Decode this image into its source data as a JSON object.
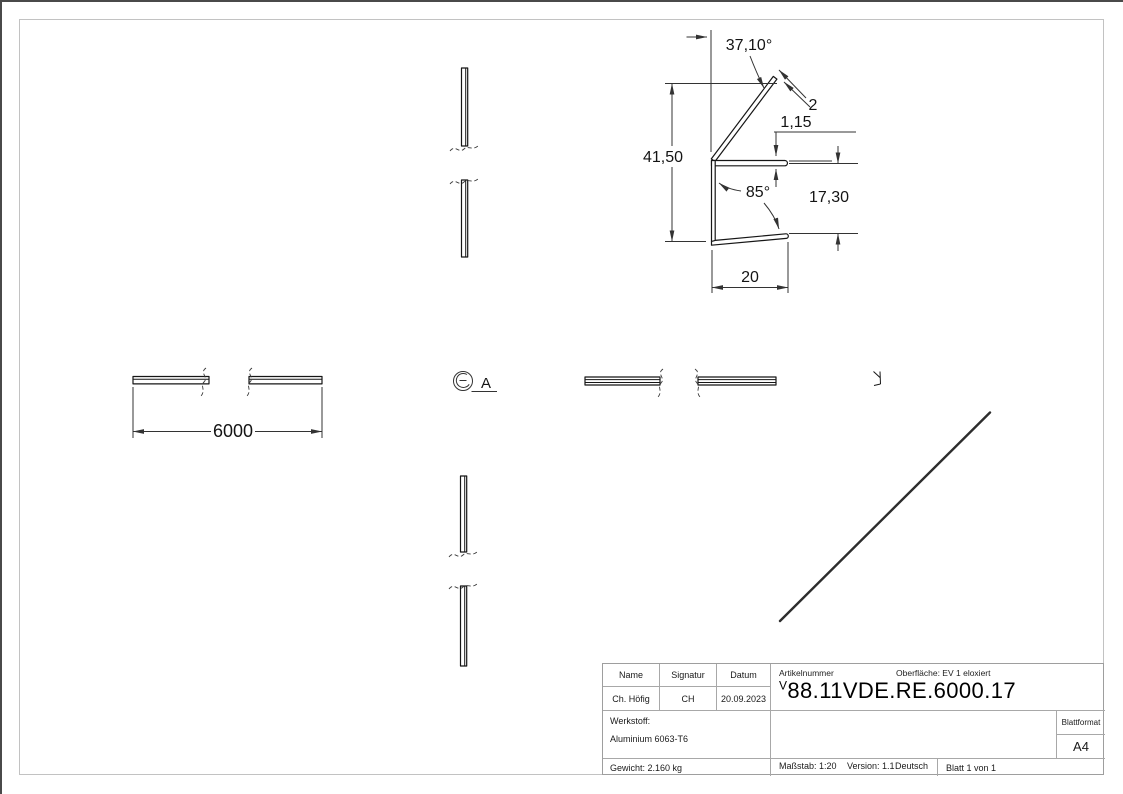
{
  "dimensions": {
    "angle_flange": "37,10°",
    "thickness": "2",
    "lip_offset": "1,15",
    "height": "41,50",
    "angle_bottom": "85°",
    "channel_height": "17,30",
    "width": "20",
    "length": "6000"
  },
  "view_labels": {
    "detail": "A"
  },
  "title_block": {
    "headers": {
      "name": "Name",
      "signatur": "Signatur",
      "datum": "Datum"
    },
    "values": {
      "name": "Ch. Höfig",
      "signatur": "CH",
      "datum": "20.09.2023"
    },
    "werkstoff_label": "Werkstoff:",
    "werkstoff_value": "Aluminium 6063-T6",
    "gewicht": "Gewicht: 2.160 kg",
    "artikelnummer_label": "Artikelnummer",
    "oberflaeche": "Oberfläche:  EV 1 eloxiert",
    "artikelnummer_sup": "V",
    "artikelnummer": "88.11VDE.RE.6000.17",
    "blattformat_label": "Blattformat",
    "blattformat_value": "A4",
    "massstab": "Maßstab: 1:20",
    "version": "Version: 1.1",
    "sprache": "Deutsch",
    "blatt": "Blatt 1 von 1"
  },
  "colors": {
    "edge_line": "#161616",
    "dimension_line": "#333333",
    "frame_line": "#c2c2c2",
    "table_line": "#a8a8a8"
  }
}
